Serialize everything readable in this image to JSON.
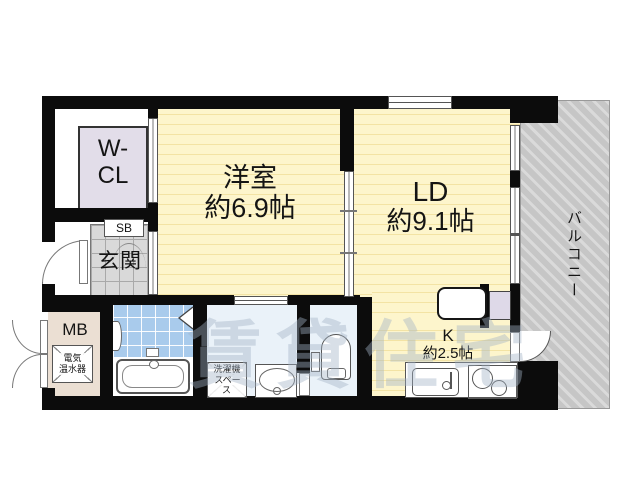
{
  "plan": {
    "watermark": "賃貸住宅",
    "rooms": {
      "walk_in_closet": {
        "line1": "W-",
        "line2": "CL"
      },
      "western_room": {
        "name": "洋室",
        "size": "約6.9帖"
      },
      "living_dining": {
        "name": "LD",
        "size": "約9.1帖"
      },
      "kitchen": {
        "name": "K",
        "size": "約2.5帖"
      },
      "balcony": {
        "name": "バルコニー"
      },
      "entrance": {
        "name": "玄関"
      },
      "shoe_box": {
        "name": "SB"
      },
      "meter_box": {
        "name": "MB"
      },
      "water_heater": {
        "line1": "電気",
        "line2": "温水器"
      },
      "laundry_space": {
        "line1": "洗濯機",
        "line2": "スペース"
      }
    },
    "colors": {
      "wall": "#0c0c0c",
      "room_floor": "#fdf5cc",
      "room_floor_stripe": "#f3e3a4",
      "closet": "#e2dde9",
      "entrance_tile": "#d9d9d9",
      "meter_box_area": "#ebdfd3",
      "bath_tile": "#a9cbec",
      "sanitary_floor": "#eaf2f9",
      "balcony": "#c6c6c6",
      "watermark_color": "#a2b2c6"
    }
  }
}
